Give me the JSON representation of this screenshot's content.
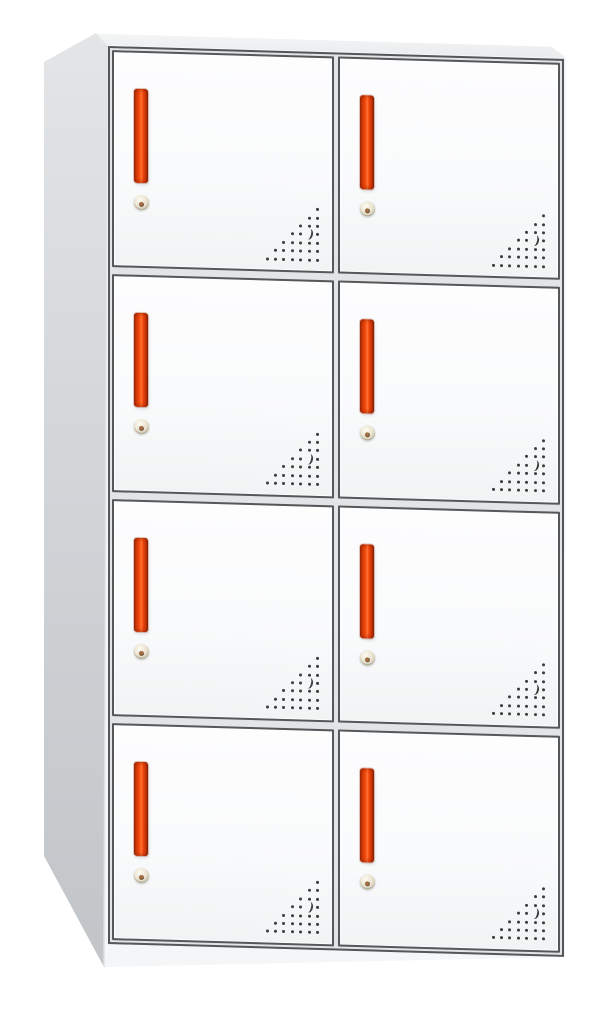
{
  "scene": {
    "type": "product-photo",
    "subject": "metal office locker storage cabinet with eight doors",
    "view": "front with left side panel visible (slight perspective)",
    "background": "#ffffff"
  },
  "cabinet": {
    "door_rows": 4,
    "door_columns": 2,
    "door_count": 8,
    "doors": [
      {
        "id": "r1c1",
        "row": 1,
        "col": 1
      },
      {
        "id": "r1c2",
        "row": 1,
        "col": 2
      },
      {
        "id": "r2c1",
        "row": 2,
        "col": 1
      },
      {
        "id": "r2c2",
        "row": 2,
        "col": 2
      },
      {
        "id": "r3c1",
        "row": 3,
        "col": 1
      },
      {
        "id": "r3c2",
        "row": 3,
        "col": 2
      },
      {
        "id": "r4c1",
        "row": 4,
        "col": 1
      },
      {
        "id": "r4c2",
        "row": 4,
        "col": 2
      }
    ],
    "door_features": {
      "handle": "vertical red recessed pull bar",
      "lock": "round brass keyhole cam lock below handle",
      "vent": "triangular grid of perforation holes in bottom-right corner with one crescent slot"
    },
    "vent_pattern": {
      "rows": 7,
      "spacing": 8.4,
      "dot_size": 3,
      "crescent_row": 3,
      "crescent_col_from_right": 1
    },
    "colors": {
      "background": "#ffffff",
      "frame_gap": "#e2e4e6",
      "frame_line": "#54575a",
      "door_face": "#fafbfc",
      "door_border": "#55585b",
      "side_top": "#e3e5e7",
      "side_mid": "#cfd3d6",
      "side_bottom": "#c1c5c8",
      "top_face_light": "#f3f5f6",
      "top_face_dark": "#e9ebed",
      "front_base": "#f5f6f7",
      "handle_core": "#f3490d",
      "handle_light": "#ff7136",
      "handle_dark": "#96280a",
      "lock_body": "#ece5d2",
      "lock_ring": "#bdb6a0",
      "lock_pin": "#5d5748",
      "vent_dot": "#3b3c3d"
    }
  }
}
